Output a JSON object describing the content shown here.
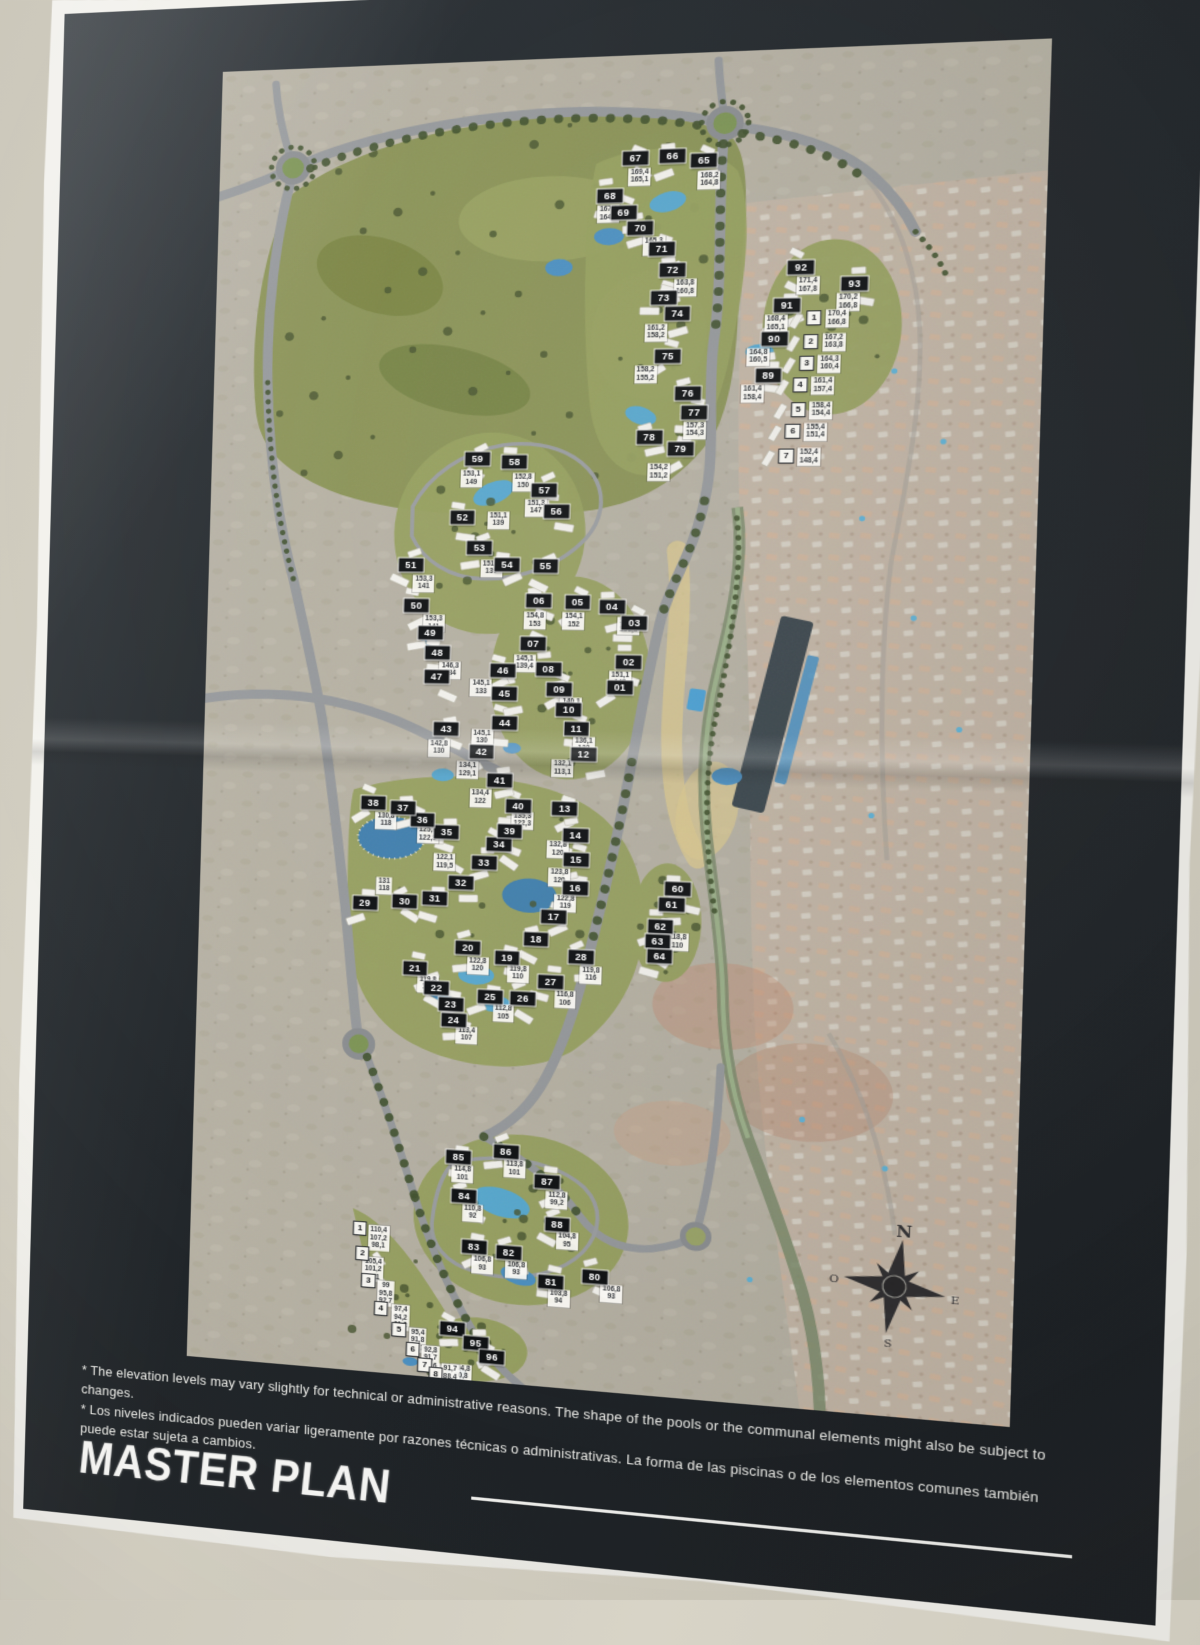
{
  "poster": {
    "title": "MASTER PLAN",
    "footnotes": {
      "en": "* The elevation levels may vary slightly for technical or administrative reasons. The shape of the pools or the communal elements might also be subject to changes.",
      "es": "* Los niveles indicados pueden variar ligeramente por razones técnicas o administrativas. La forma de las piscinas o de los elementos comunes también puede estar sujeta a cambios."
    },
    "background": "#23282c",
    "paper_color": "#f2f1ec",
    "wall_color": "#cfcbbe"
  },
  "compass": {
    "north": "N",
    "east": "E",
    "south": "S",
    "west": "O"
  },
  "legend_colors": {
    "plot_label_bg": "#101214",
    "plot_label_text": "#ffffff",
    "unit_label_bg": "#f5f4ef",
    "unit_label_text": "#17191c",
    "golf_green": "#8a9356",
    "development_green": "#96a05e",
    "water": "#4a90c2",
    "road": "#95989b",
    "sand_wash": "#dcc98e"
  },
  "map": {
    "plots": [
      {
        "n": "01",
        "x": 374,
        "y": 588
      },
      {
        "n": "02",
        "x": 381,
        "y": 564
      },
      {
        "n": "03",
        "x": 385,
        "y": 528
      },
      {
        "n": "04",
        "x": 365,
        "y": 513
      },
      {
        "n": "05",
        "x": 335,
        "y": 509
      },
      {
        "n": "06",
        "x": 301,
        "y": 508
      },
      {
        "n": "07",
        "x": 297,
        "y": 549
      },
      {
        "n": "08",
        "x": 311,
        "y": 572
      },
      {
        "n": "09",
        "x": 321,
        "y": 591
      },
      {
        "n": "10",
        "x": 330,
        "y": 610
      },
      {
        "n": "11",
        "x": 337,
        "y": 627
      },
      {
        "n": "12",
        "x": 344,
        "y": 651
      },
      {
        "n": "13",
        "x": 329,
        "y": 702
      },
      {
        "n": "14",
        "x": 339,
        "y": 727
      },
      {
        "n": "15",
        "x": 340,
        "y": 750
      },
      {
        "n": "16",
        "x": 340,
        "y": 776
      },
      {
        "n": "17",
        "x": 322,
        "y": 804
      },
      {
        "n": "18",
        "x": 307,
        "y": 826
      },
      {
        "n": "19",
        "x": 282,
        "y": 844
      },
      {
        "n": "20",
        "x": 247,
        "y": 837
      },
      {
        "n": "21",
        "x": 200,
        "y": 858
      },
      {
        "n": "22",
        "x": 220,
        "y": 876
      },
      {
        "n": "23",
        "x": 233,
        "y": 891
      },
      {
        "n": "24",
        "x": 236,
        "y": 906
      },
      {
        "n": "25",
        "x": 268,
        "y": 882
      },
      {
        "n": "26",
        "x": 297,
        "y": 882
      },
      {
        "n": "27",
        "x": 321,
        "y": 865
      },
      {
        "n": "28",
        "x": 347,
        "y": 841
      },
      {
        "n": "29",
        "x": 153,
        "y": 798
      },
      {
        "n": "30",
        "x": 189,
        "y": 795
      },
      {
        "n": "31",
        "x": 216,
        "y": 791
      },
      {
        "n": "32",
        "x": 239,
        "y": 775
      },
      {
        "n": "33",
        "x": 259,
        "y": 756
      },
      {
        "n": "34",
        "x": 272,
        "y": 738
      },
      {
        "n": "35",
        "x": 225,
        "y": 728
      },
      {
        "n": "36",
        "x": 203,
        "y": 717
      },
      {
        "n": "37",
        "x": 185,
        "y": 706
      },
      {
        "n": "38",
        "x": 158,
        "y": 702
      },
      {
        "n": "39",
        "x": 281,
        "y": 725
      },
      {
        "n": "40",
        "x": 288,
        "y": 701
      },
      {
        "n": "41",
        "x": 271,
        "y": 678
      },
      {
        "n": "42",
        "x": 254,
        "y": 651
      },
      {
        "n": "43",
        "x": 222,
        "y": 630
      },
      {
        "n": "44",
        "x": 274,
        "y": 623
      },
      {
        "n": "45",
        "x": 273,
        "y": 596
      },
      {
        "n": "46",
        "x": 271,
        "y": 574
      },
      {
        "n": "47",
        "x": 212,
        "y": 581
      },
      {
        "n": "48",
        "x": 212,
        "y": 558
      },
      {
        "n": "49",
        "x": 205,
        "y": 540
      },
      {
        "n": "50",
        "x": 192,
        "y": 514
      },
      {
        "n": "51",
        "x": 186,
        "y": 476
      },
      {
        "n": "52",
        "x": 231,
        "y": 430
      },
      {
        "n": "53",
        "x": 247,
        "y": 459
      },
      {
        "n": "54",
        "x": 272,
        "y": 475
      },
      {
        "n": "55",
        "x": 306,
        "y": 476
      },
      {
        "n": "56",
        "x": 314,
        "y": 424
      },
      {
        "n": "57",
        "x": 303,
        "y": 404
      },
      {
        "n": "58",
        "x": 276,
        "y": 378
      },
      {
        "n": "59",
        "x": 243,
        "y": 375
      },
      {
        "n": "60",
        "x": 429,
        "y": 773
      },
      {
        "n": "61",
        "x": 424,
        "y": 788
      },
      {
        "n": "62",
        "x": 415,
        "y": 809
      },
      {
        "n": "63",
        "x": 413,
        "y": 823
      },
      {
        "n": "64",
        "x": 415,
        "y": 837
      },
      {
        "n": "65",
        "x": 433,
        "y": 100
      },
      {
        "n": "66",
        "x": 406,
        "y": 95
      },
      {
        "n": "67",
        "x": 374,
        "y": 96
      },
      {
        "n": "68",
        "x": 353,
        "y": 130
      },
      {
        "n": "69",
        "x": 365,
        "y": 146
      },
      {
        "n": "70",
        "x": 380,
        "y": 161
      },
      {
        "n": "71",
        "x": 399,
        "y": 181
      },
      {
        "n": "72",
        "x": 409,
        "y": 200
      },
      {
        "n": "73",
        "x": 402,
        "y": 226
      },
      {
        "n": "74",
        "x": 414,
        "y": 241
      },
      {
        "n": "75",
        "x": 407,
        "y": 280
      },
      {
        "n": "76",
        "x": 425,
        "y": 315
      },
      {
        "n": "77",
        "x": 431,
        "y": 332
      },
      {
        "n": "78",
        "x": 393,
        "y": 355
      },
      {
        "n": "79",
        "x": 420,
        "y": 366
      },
      {
        "n": "80",
        "x": 367,
        "y": 1138
      },
      {
        "n": "81",
        "x": 329,
        "y": 1146
      },
      {
        "n": "82",
        "x": 291,
        "y": 1122
      },
      {
        "n": "83",
        "x": 260,
        "y": 1119
      },
      {
        "n": "84",
        "x": 250,
        "y": 1071
      },
      {
        "n": "85",
        "x": 244,
        "y": 1035
      },
      {
        "n": "86",
        "x": 286,
        "y": 1027
      },
      {
        "n": "87",
        "x": 323,
        "y": 1053
      },
      {
        "n": "88",
        "x": 333,
        "y": 1092
      },
      {
        "n": "89",
        "x": 493,
        "y": 299
      },
      {
        "n": "90",
        "x": 497,
        "y": 265
      },
      {
        "n": "91",
        "x": 507,
        "y": 235
      },
      {
        "n": "92",
        "x": 518,
        "y": 200
      },
      {
        "n": "93",
        "x": 563,
        "y": 216
      },
      {
        "n": "94",
        "x": 243,
        "y": 1198
      },
      {
        "n": "95",
        "x": 264,
        "y": 1209
      },
      {
        "n": "96",
        "x": 279,
        "y": 1221
      }
    ],
    "units_upper": [
      {
        "n": "1",
        "x": 530,
        "y": 247
      },
      {
        "n": "2",
        "x": 528,
        "y": 268
      },
      {
        "n": "3",
        "x": 525,
        "y": 288
      },
      {
        "n": "4",
        "x": 520,
        "y": 308
      },
      {
        "n": "5",
        "x": 519,
        "y": 330
      },
      {
        "n": "6",
        "x": 515,
        "y": 350
      },
      {
        "n": "7",
        "x": 510,
        "y": 373
      }
    ],
    "units_lower": [
      {
        "n": "1",
        "x": 157,
        "y": 1109
      },
      {
        "n": "2",
        "x": 160,
        "y": 1133
      },
      {
        "n": "3",
        "x": 166,
        "y": 1158
      },
      {
        "n": "4",
        "x": 178,
        "y": 1184
      },
      {
        "n": "5",
        "x": 195,
        "y": 1203
      },
      {
        "n": "6",
        "x": 208,
        "y": 1220
      },
      {
        "n": "7",
        "x": 219,
        "y": 1234
      },
      {
        "n": "8",
        "x": 229,
        "y": 1242
      }
    ],
    "elevations": [
      {
        "lines": [
          "169,4",
          "165,1"
        ],
        "x": 378,
        "y": 113
      },
      {
        "lines": [
          "168,2",
          "164,8"
        ],
        "x": 438,
        "y": 118
      },
      {
        "lines": [
          "167,1",
          "164,1"
        ],
        "x": 352,
        "y": 147
      },
      {
        "lines": [
          "165,3",
          "162"
        ],
        "x": 392,
        "y": 178
      },
      {
        "lines": [
          "163,8",
          "160,8"
        ],
        "x": 420,
        "y": 217
      },
      {
        "lines": [
          "161,2",
          "158,2"
        ],
        "x": 396,
        "y": 258
      },
      {
        "lines": [
          "158,2",
          "155,2"
        ],
        "x": 388,
        "y": 297
      },
      {
        "lines": [
          "157,3",
          "154,3"
        ],
        "x": 432,
        "y": 349
      },
      {
        "lines": [
          "154,2",
          "151,2"
        ],
        "x": 402,
        "y": 388
      },
      {
        "lines": [
          "171,4",
          "167,8"
        ],
        "x": 524,
        "y": 217
      },
      {
        "lines": [
          "170,2",
          "166,8"
        ],
        "x": 558,
        "y": 233
      },
      {
        "lines": [
          "168,4",
          "165,1"
        ],
        "x": 498,
        "y": 252
      },
      {
        "lines": [
          "164,8",
          "160,5"
        ],
        "x": 484,
        "y": 282
      },
      {
        "lines": [
          "161,4",
          "158,4"
        ],
        "x": 480,
        "y": 316
      },
      {
        "lines": [
          "170,4",
          "166,8"
        ],
        "x": 549,
        "y": 248
      },
      {
        "lines": [
          "167,2",
          "163,8"
        ],
        "x": 547,
        "y": 269
      },
      {
        "lines": [
          "164,3",
          "160,4"
        ],
        "x": 544,
        "y": 289
      },
      {
        "lines": [
          "161,4",
          "157,4"
        ],
        "x": 539,
        "y": 309
      },
      {
        "lines": [
          "158,4",
          "154,4"
        ],
        "x": 538,
        "y": 331
      },
      {
        "lines": [
          "155,4",
          "151,4"
        ],
        "x": 534,
        "y": 351
      },
      {
        "lines": [
          "152,4",
          "148,4"
        ],
        "x": 529,
        "y": 374
      },
      {
        "lines": [
          "153,1",
          "149"
        ],
        "x": 238,
        "y": 394
      },
      {
        "lines": [
          "152,8",
          "150"
        ],
        "x": 284,
        "y": 397
      },
      {
        "lines": [
          "151,3",
          "147"
        ],
        "x": 296,
        "y": 421
      },
      {
        "lines": [
          "151,1",
          "139"
        ],
        "x": 263,
        "y": 433
      },
      {
        "lines": [
          "151,3",
          "139"
        ],
        "x": 258,
        "y": 478
      },
      {
        "lines": [
          "153,3",
          "141"
        ],
        "x": 198,
        "y": 493
      },
      {
        "lines": [
          "153,3",
          "141"
        ],
        "x": 208,
        "y": 531
      },
      {
        "lines": [
          "155,8",
          "153,8"
        ],
        "x": 380,
        "y": 531
      },
      {
        "lines": [
          "154,1",
          "152"
        ],
        "x": 332,
        "y": 527
      },
      {
        "lines": [
          "154,8",
          "153"
        ],
        "x": 298,
        "y": 527
      },
      {
        "lines": [
          "151,1",
          "148"
        ],
        "x": 374,
        "y": 581
      },
      {
        "lines": [
          "145,1",
          "139,4"
        ],
        "x": 290,
        "y": 567
      },
      {
        "lines": [
          "140,1",
          "136"
        ],
        "x": 332,
        "y": 607
      },
      {
        "lines": [
          "136,1",
          "132"
        ],
        "x": 344,
        "y": 643
      },
      {
        "lines": [
          "132,1",
          "113,1"
        ],
        "x": 326,
        "y": 665
      },
      {
        "lines": [
          "146,3",
          "134"
        ],
        "x": 224,
        "y": 575
      },
      {
        "lines": [
          "145,1",
          "133"
        ],
        "x": 252,
        "y": 591
      },
      {
        "lines": [
          "145,1",
          "130"
        ],
        "x": 254,
        "y": 638
      },
      {
        "lines": [
          "142,8",
          "130"
        ],
        "x": 216,
        "y": 649
      },
      {
        "lines": [
          "134,1",
          "129,1"
        ],
        "x": 242,
        "y": 669
      },
      {
        "lines": [
          "134,4",
          "122"
        ],
        "x": 254,
        "y": 695
      },
      {
        "lines": [
          "135,3",
          "122,3"
        ],
        "x": 292,
        "y": 715
      },
      {
        "lines": [
          "132,8",
          "120"
        ],
        "x": 324,
        "y": 741
      },
      {
        "lines": [
          "123,8",
          "120"
        ],
        "x": 326,
        "y": 767
      },
      {
        "lines": [
          "122,8",
          "119"
        ],
        "x": 332,
        "y": 791
      },
      {
        "lines": [
          "130,8",
          "118"
        ],
        "x": 170,
        "y": 719
      },
      {
        "lines": [
          "125,3",
          "122,3"
        ],
        "x": 208,
        "y": 731
      },
      {
        "lines": [
          "122,1",
          "119,5"
        ],
        "x": 224,
        "y": 757
      },
      {
        "lines": [
          "131",
          "118"
        ],
        "x": 170,
        "y": 781
      },
      {
        "lines": [
          "122,8",
          "120"
        ],
        "x": 256,
        "y": 853
      },
      {
        "lines": [
          "119,8",
          "110"
        ],
        "x": 292,
        "y": 859
      },
      {
        "lines": [
          "119,8",
          "116"
        ],
        "x": 356,
        "y": 857
      },
      {
        "lines": [
          "119,8",
          "107"
        ],
        "x": 212,
        "y": 873
      },
      {
        "lines": [
          "116,8",
          "106"
        ],
        "x": 334,
        "y": 881
      },
      {
        "lines": [
          "112,8",
          "105"
        ],
        "x": 280,
        "y": 897
      },
      {
        "lines": [
          "113,4",
          "107"
        ],
        "x": 248,
        "y": 919
      },
      {
        "lines": [
          "118,8",
          "110"
        ],
        "x": 430,
        "y": 823
      },
      {
        "lines": [
          "114,8",
          "101"
        ],
        "x": 248,
        "y": 1051
      },
      {
        "lines": [
          "113,8",
          "101"
        ],
        "x": 294,
        "y": 1043
      },
      {
        "lines": [
          "112,8",
          "99,2"
        ],
        "x": 332,
        "y": 1069
      },
      {
        "lines": [
          "110,8",
          "92"
        ],
        "x": 258,
        "y": 1087
      },
      {
        "lines": [
          "104,8",
          "95"
        ],
        "x": 342,
        "y": 1107
      },
      {
        "lines": [
          "106,8",
          "93"
        ],
        "x": 268,
        "y": 1135
      },
      {
        "lines": [
          "106,8",
          "93"
        ],
        "x": 298,
        "y": 1137
      },
      {
        "lines": [
          "103,8",
          "94"
        ],
        "x": 336,
        "y": 1161
      },
      {
        "lines": [
          "106,8",
          "93"
        ],
        "x": 382,
        "y": 1153
      },
      {
        "lines": [
          "104,8",
          "90,8"
        ],
        "x": 252,
        "y": 1239
      },
      {
        "lines": [
          "110,4",
          "107,2",
          "98,1"
        ],
        "x": 174,
        "y": 1117
      },
      {
        "lines": [
          "105,4",
          "101,2",
          "98,1"
        ],
        "x": 170,
        "y": 1147
      },
      {
        "lines": [
          "99",
          "95,8",
          "92,7"
        ],
        "x": 182,
        "y": 1169
      },
      {
        "lines": [
          "97,4",
          "94,2",
          "91,2"
        ],
        "x": 196,
        "y": 1191
      },
      {
        "lines": [
          "95,4",
          "91,8",
          "88,7"
        ],
        "x": 212,
        "y": 1211
      },
      {
        "lines": [
          "92,8",
          "91,7",
          "90,6"
        ],
        "x": 224,
        "y": 1227
      },
      {
        "lines": [
          "91,7",
          "88,4",
          "85,4"
        ],
        "x": 242,
        "y": 1243
      }
    ]
  }
}
